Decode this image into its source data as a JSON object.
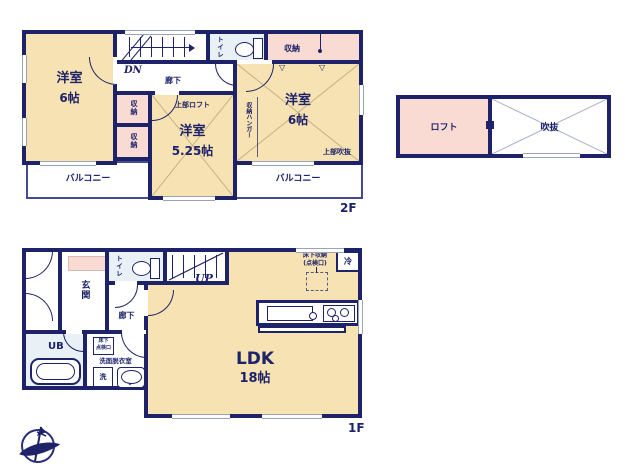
{
  "palette": {
    "wall": "#1d2269",
    "room_fill": "#f6e2b2",
    "closet_fill": "#f9dbd4",
    "bath_fill": "#e9f1f7",
    "window_line": "#9ba3bb"
  },
  "floor2": {
    "floor_label": "2F",
    "room_left": {
      "name": "洋室",
      "size": "6帖"
    },
    "room_center": {
      "name": "洋室",
      "size": "5.25帖"
    },
    "room_right": {
      "name": "洋室",
      "size": "6帖"
    },
    "upper_loft_label": "上部ロフト",
    "upper_void_label": "上部吹抜",
    "hall_label": "廊下",
    "stairs_label": "DN",
    "toilet_label": "トイレ",
    "closet_top_label": "収納",
    "closet_a_label": "収納",
    "closet_b_label": "収納",
    "hanger_label": "収納ハンガー",
    "balcony_left_label": "バルコニー",
    "balcony_right_label": "バルコニー",
    "door_marker": "▽"
  },
  "loft_block": {
    "loft_label": "ロフト",
    "void_label": "吹抜"
  },
  "floor1": {
    "floor_label": "1F",
    "entrance_label": "玄関",
    "toilet_label": "トイレ",
    "stairs_label": "UP",
    "hall_label": "廊下",
    "ldk": {
      "name": "LDK",
      "size": "18帖"
    },
    "ub_label": "UB",
    "washroom_label": "洗面脱衣室",
    "washer_label": "洗",
    "hatch_line1": "床下",
    "hatch_line2": "点検口",
    "underfloor_line1": "床下収納",
    "underfloor_line2": "(点検口)",
    "fridge_label": "冷"
  }
}
